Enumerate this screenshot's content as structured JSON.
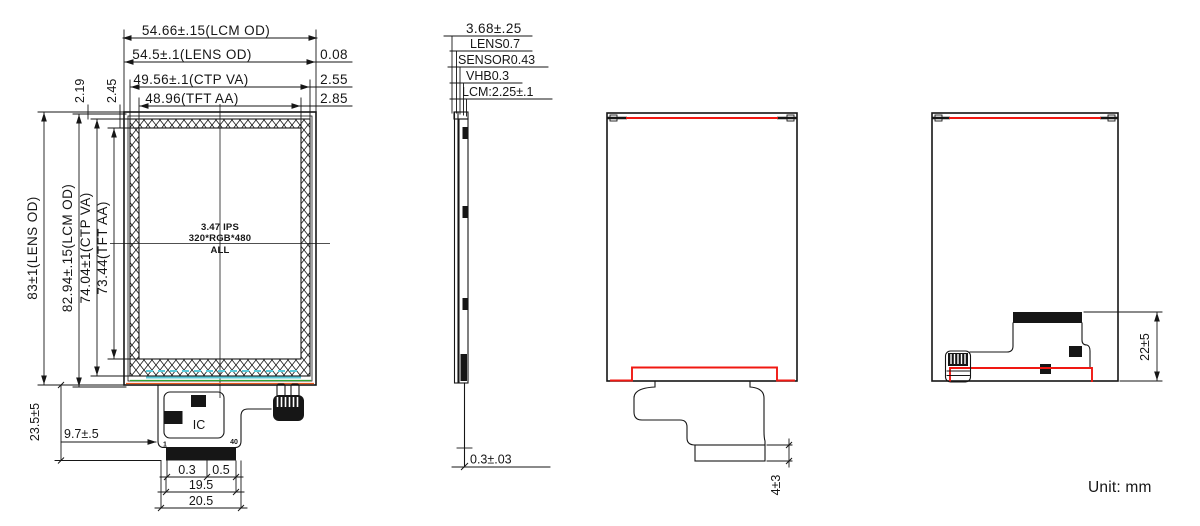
{
  "drawing": {
    "unit_note": "Unit: mm",
    "front_view": {
      "top_dims": [
        {
          "label": "54.66±.15(LCM OD)"
        },
        {
          "label": "54.5±.1(LENS OD)",
          "right_offset": "0.08"
        },
        {
          "label": "49.56±.1(CTP VA)",
          "right_offset": "2.55"
        },
        {
          "label": "48.96(TFT AA)",
          "right_offset": "2.85"
        }
      ],
      "left_dims": [
        {
          "label": "83±1(LENS OD)"
        },
        {
          "label": "82.94±.15(LCM OD)"
        },
        {
          "label": "74.04±1(CTP VA)"
        },
        {
          "label": "73.44(TFT AA)"
        }
      ],
      "top_gap_dims": [
        {
          "label": "2.19"
        },
        {
          "label": "2.45"
        }
      ],
      "panel_label": {
        "line1": "3.47 IPS",
        "line2": "320*RGB*480",
        "line3": "ALL"
      },
      "ic_label": "IC",
      "pin_labels": {
        "first": "1",
        "last": "40"
      },
      "connector_dims": [
        {
          "label": "0.3"
        },
        {
          "label": "0.5"
        },
        {
          "label": "19.5"
        },
        {
          "label": "20.5"
        }
      ],
      "fpc_dims": [
        {
          "label": "23.5±5"
        },
        {
          "label": "9.7±.5"
        }
      ]
    },
    "side_view": {
      "total_thickness": "3.68±.25",
      "stack_layers": [
        {
          "label": "LENS0.7"
        },
        {
          "label": "SENSOR0.43"
        },
        {
          "label": "VHB0.3"
        },
        {
          "label": "LCM:2.25±.1"
        }
      ],
      "fpc_thickness": "0.3±.03"
    },
    "back_view_fpc_down": {
      "connector_height": "4±3"
    },
    "back_view_fpc_folded": {
      "fold_height": "22±5"
    }
  },
  "colors": {
    "ink": "#161616",
    "red_accent": "#f01812",
    "cyan_accent": "#5ac8d8",
    "green_accent": "#2fa32f",
    "orange_accent": "#e8581c"
  }
}
